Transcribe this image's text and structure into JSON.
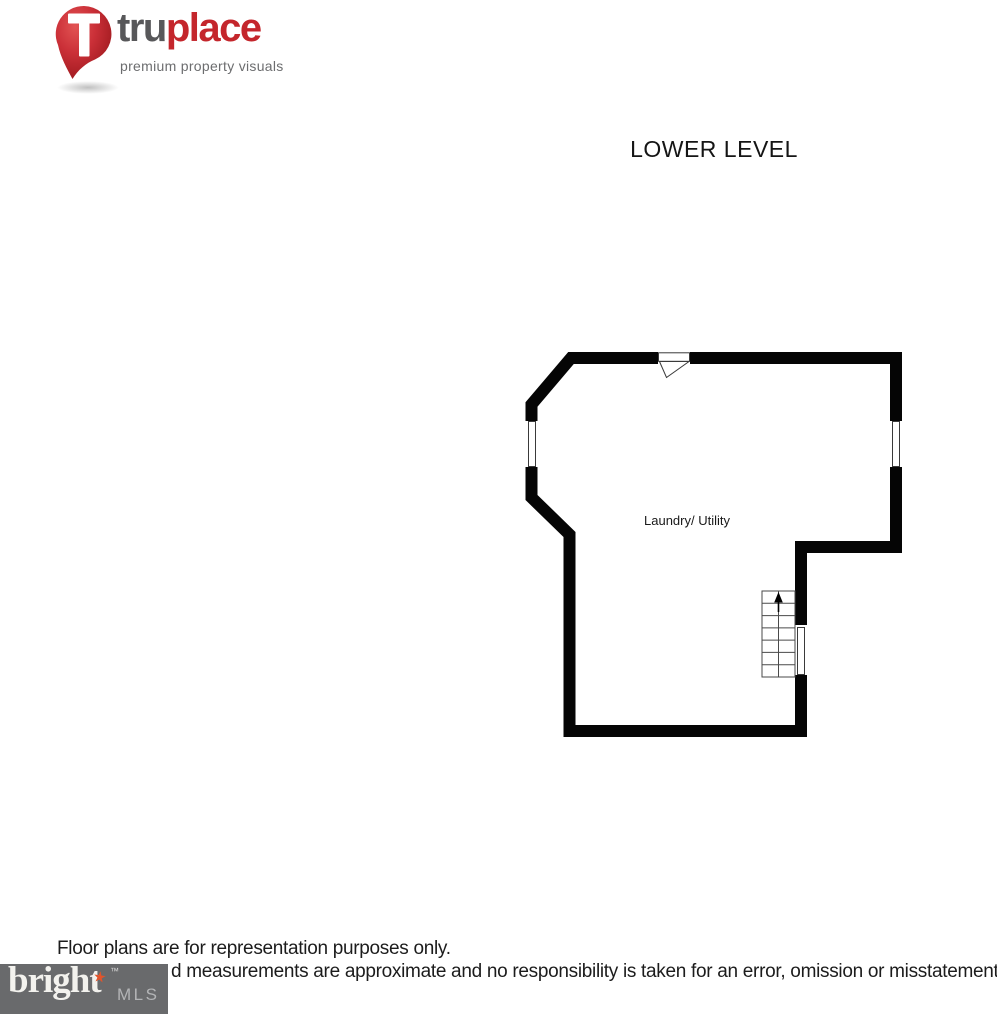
{
  "brand": {
    "name_part1": "tru",
    "name_part2": "place",
    "tagline": "premium property visuals",
    "color_gray": "#58585a",
    "color_red": "#c4262c"
  },
  "page": {
    "title": "LOWER LEVEL"
  },
  "floorplan": {
    "room_label": "Laundry/ Utility",
    "wall_color": "#000000",
    "icons": {
      "door": "entry-door-swing",
      "window_left": "window",
      "window_right": "window",
      "wall_opening": "wall-opening",
      "stairs": "stairs-with-up-arrow"
    }
  },
  "footer": {
    "line1": "Floor plans are for representation purposes only.",
    "line2": "d measurements are approximate and no responsibility is taken for an error, omission or misstatement"
  },
  "mls": {
    "word": "bright",
    "star": "★",
    "tm": "™",
    "suffix": "MLS",
    "bg_color": "#696a6c"
  }
}
